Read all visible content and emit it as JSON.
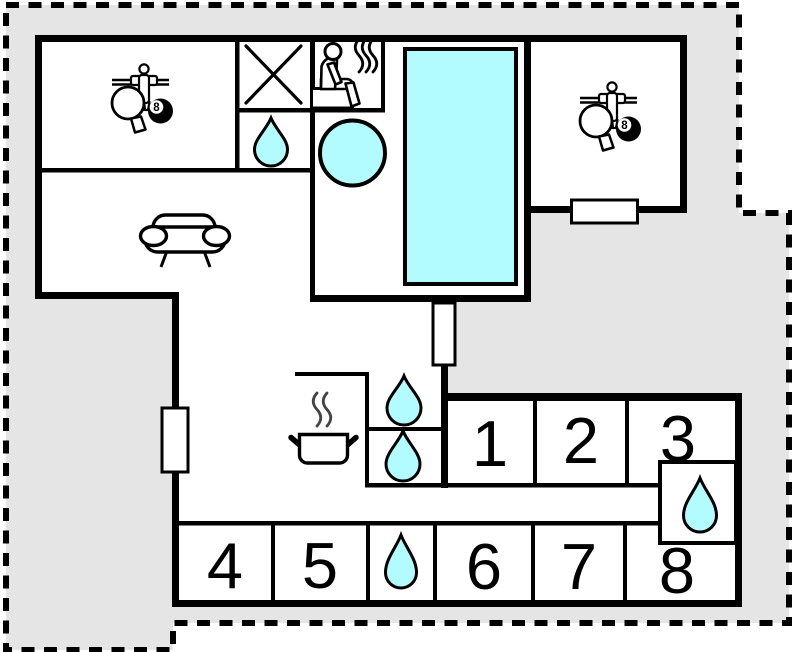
{
  "title": "holiday-home-floor-plan",
  "colors": {
    "water": "#b2fcff",
    "outside": "#e5e5e5",
    "floor": "#ffffff",
    "wall": "#000000"
  },
  "rooms": [
    {
      "label": "1"
    },
    {
      "label": "2"
    },
    {
      "label": "3"
    },
    {
      "label": "4"
    },
    {
      "label": "5"
    },
    {
      "label": "6"
    },
    {
      "label": "7"
    },
    {
      "label": "8"
    }
  ],
  "icons": {
    "eight_ball_label": "8",
    "names": [
      "table-tennis-icon",
      "foosball-icon",
      "billiard-ball-icon",
      "sauna-icon",
      "hot-tub-icon",
      "swimming-pool-icon",
      "water-drop-icon",
      "sofa-icon",
      "cooking-pot-icon",
      "cross-room-icon",
      "window-marker",
      "door-marker",
      "property-boundary"
    ]
  }
}
